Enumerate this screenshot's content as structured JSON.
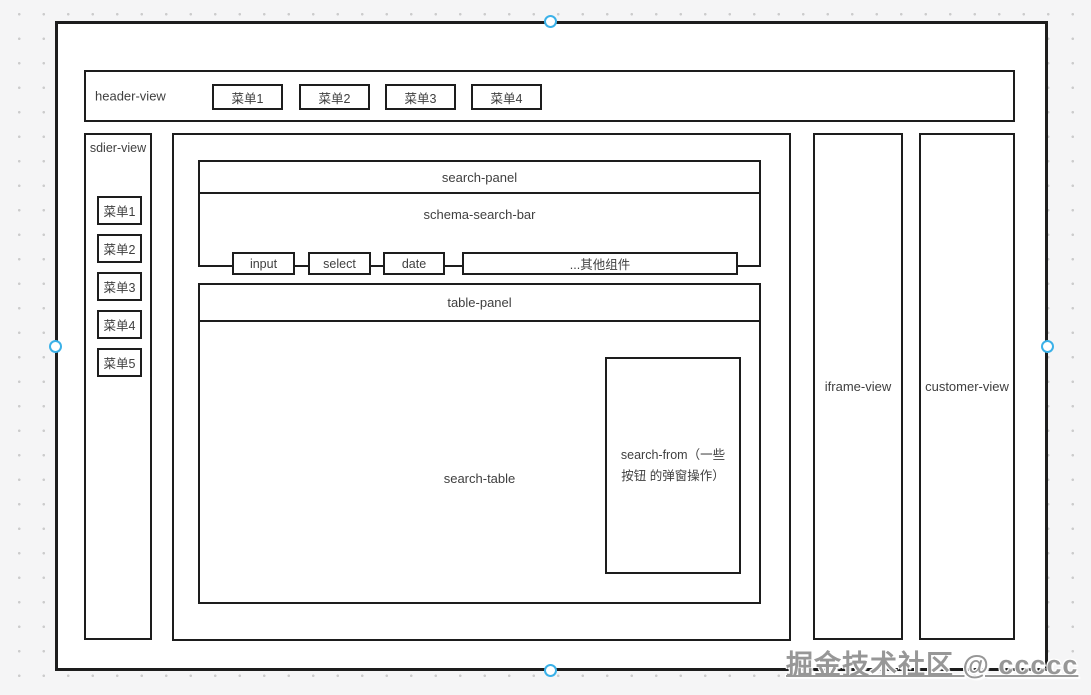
{
  "header": {
    "label": "header-view",
    "menus": [
      "菜单1",
      "菜单2",
      "菜单3",
      "菜单4"
    ]
  },
  "sidebar": {
    "label": "sdier-view",
    "menus": [
      "菜单1",
      "菜单2",
      "菜单3",
      "菜单4",
      "菜单5"
    ]
  },
  "main": {
    "search_panel": {
      "label": "search-panel",
      "schema_search_bar": {
        "label": "schema-search-bar",
        "components": [
          "input",
          "select",
          "date",
          "...其他组件"
        ]
      }
    },
    "table_panel": {
      "label": "table-panel",
      "search_table_label": "search-table",
      "search_form_label": "search-from（一些按钮 的弹窗操作）"
    }
  },
  "right_panels": {
    "iframe_label": "iframe-view",
    "customer_label": "customer-view"
  },
  "watermark": "掘金技术社区 @ ccccc",
  "colors": {
    "stroke": "#1d1d1d",
    "canvas_bg": "#f5f5f6",
    "grid_dot": "#cccccc",
    "handle_accent": "#3bb1e8",
    "watermark_gray": "#979797"
  }
}
